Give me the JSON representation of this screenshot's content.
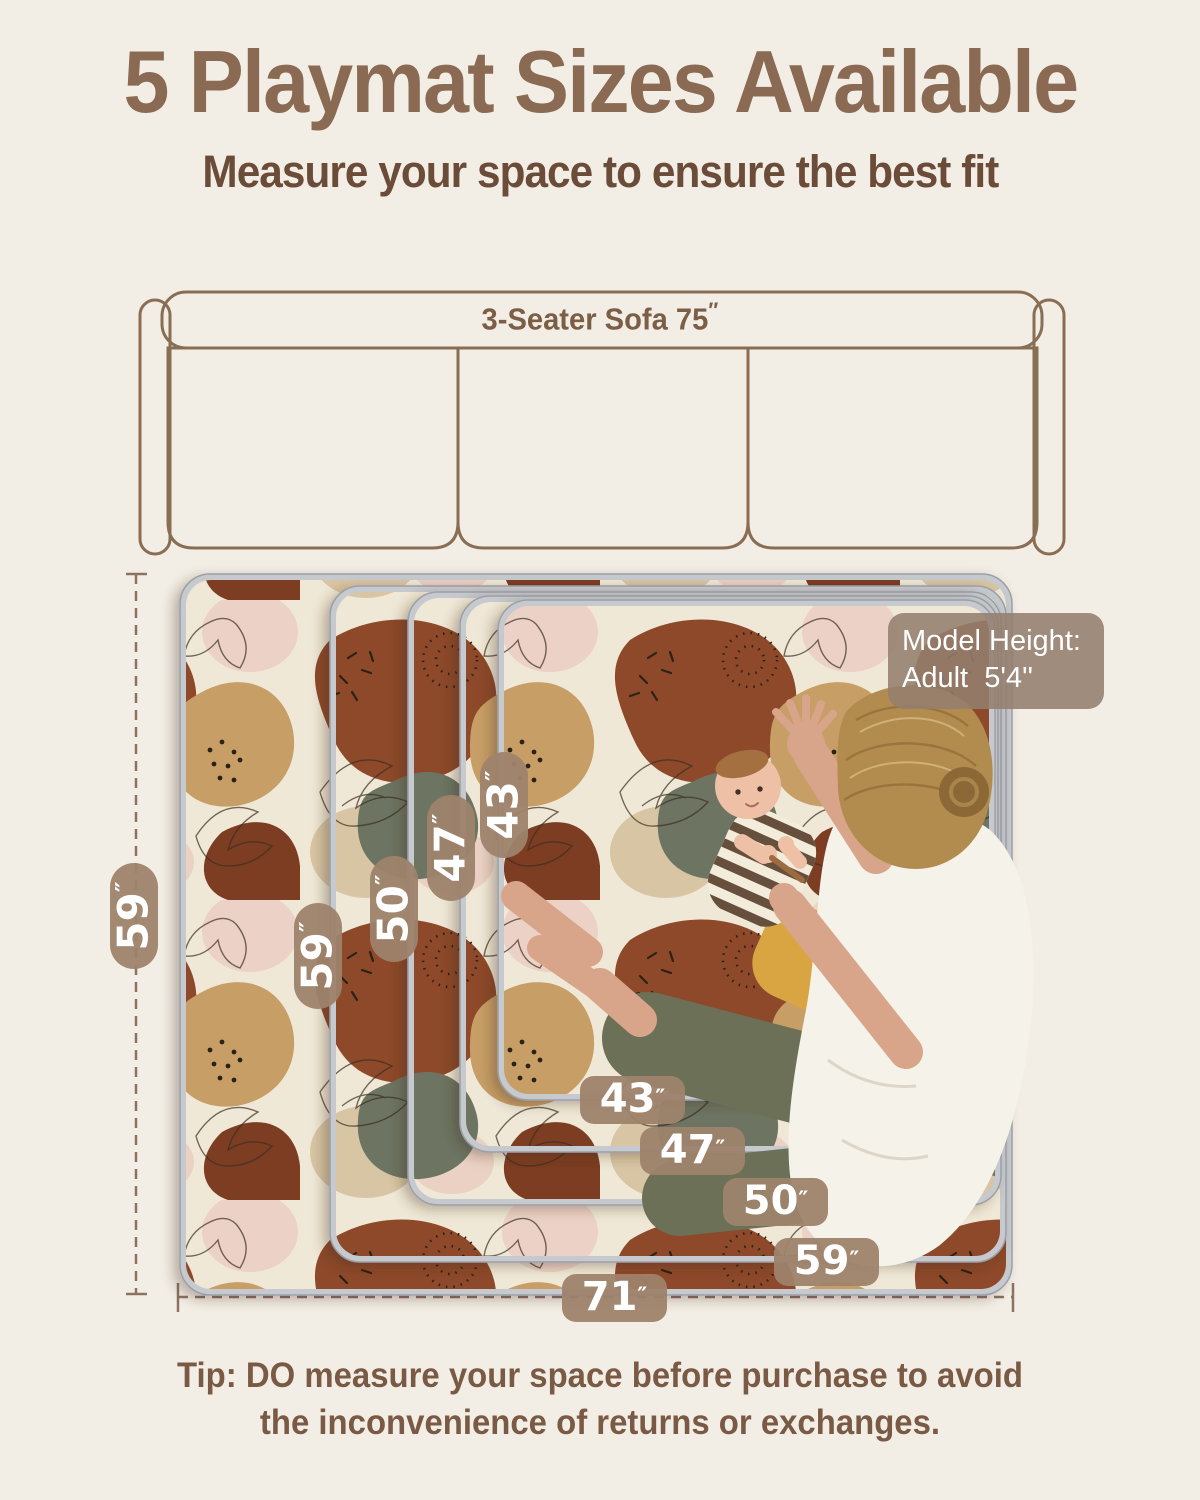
{
  "colors": {
    "background": "#f3eee5",
    "title": "#8a6a52",
    "subtitle": "#6b4c38",
    "pill_background": "#9e836c",
    "sofa_outline": "#8a6e54",
    "tip_text": "#7a5a45",
    "mat_rust": "#8d4a2c",
    "mat_olive": "#6d7462",
    "mat_tan": "#c79e66",
    "mat_cream": "#f0e8d6"
  },
  "header": {
    "title": "5 Playmat Sizes Available",
    "subtitle": "Measure your space to ensure the best fit"
  },
  "sofa": {
    "label": "3-Seater Sofa 75",
    "unit": "″"
  },
  "mats": {
    "overall_height": {
      "value": "59",
      "unit": "″"
    },
    "overall_width": {
      "value": "71",
      "unit": "″"
    },
    "side_labels": [
      {
        "value": "59",
        "unit": "″"
      },
      {
        "value": "50",
        "unit": "″"
      },
      {
        "value": "47",
        "unit": "″"
      },
      {
        "value": "43",
        "unit": "″"
      }
    ],
    "bottom_labels": [
      {
        "value": "43",
        "unit": "″"
      },
      {
        "value": "47",
        "unit": "″"
      },
      {
        "value": "50",
        "unit": "″"
      },
      {
        "value": "59",
        "unit": "″"
      }
    ]
  },
  "model_height": {
    "line1": "Model Height:",
    "line2": "Adult  5'4''"
  },
  "tip": {
    "line1": "Tip: DO measure your space before purchase to avoid",
    "line2": "the inconvenience of returns or exchanges."
  }
}
